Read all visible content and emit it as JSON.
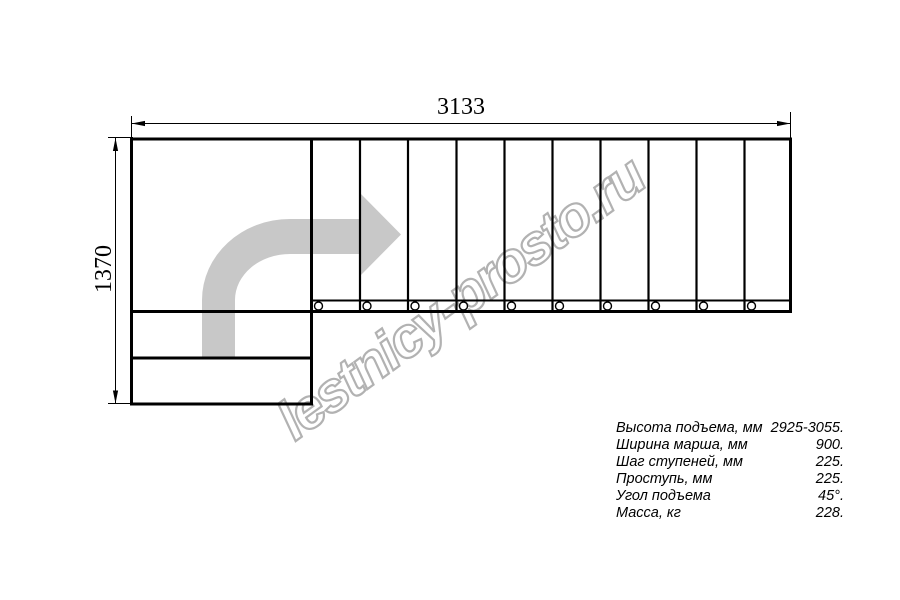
{
  "drawing": {
    "description": "L-shaped staircase plan, top view",
    "dim_width_label": "3133",
    "dim_height_label": "1370",
    "upper_flight_treads": 10,
    "lower_steps": 2,
    "support_circles": 10,
    "arrow_color": "#c8c8c8",
    "line_color": "#000000"
  },
  "watermark": {
    "text": "lestnicy-prosto.ru",
    "outline_color": "#b2b2b2"
  },
  "specs": {
    "rows": [
      {
        "label": "Высота подъема, мм",
        "value": "2925-3055."
      },
      {
        "label": "Ширина марша, мм",
        "value": "900."
      },
      {
        "label": "Шаг ступеней, мм",
        "value": "225."
      },
      {
        "label": "Проступь, мм",
        "value": "225."
      },
      {
        "label": "Угол подъема",
        "value": "45°."
      },
      {
        "label": "Масса, кг",
        "value": "228."
      }
    ]
  }
}
